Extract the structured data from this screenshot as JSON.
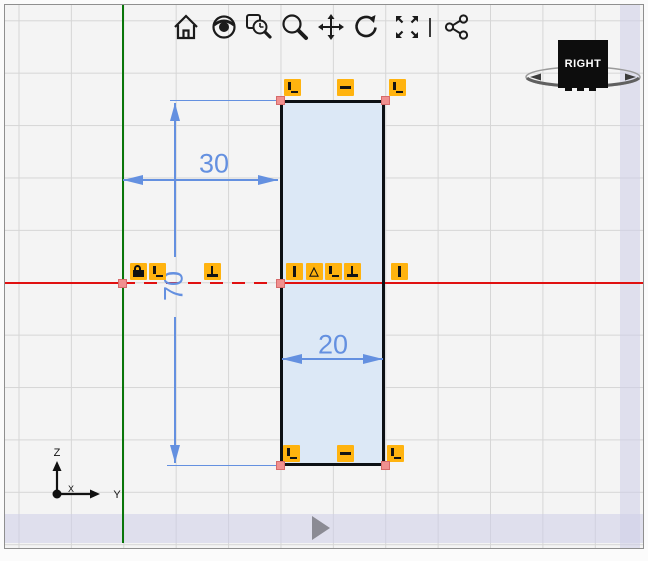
{
  "toolbar": {
    "icons": [
      {
        "name": "home"
      },
      {
        "name": "view-orientation"
      },
      {
        "name": "zoom-window"
      },
      {
        "name": "zoom"
      },
      {
        "name": "pan"
      },
      {
        "name": "rotate"
      },
      {
        "name": "zoom-to-fit"
      },
      {
        "name": "share-view"
      }
    ]
  },
  "view_cube": {
    "face_label": "RIGHT"
  },
  "triad": {
    "axis_x_label": "X",
    "axis_y_label": "Y",
    "axis_z_label": "Z"
  },
  "sketch": {
    "dimensions": [
      {
        "id": "offset-from-origin",
        "value": "30"
      },
      {
        "id": "height",
        "value": "70"
      },
      {
        "id": "width",
        "value": "20"
      }
    ],
    "badges": [
      {
        "type": "coincident",
        "x": 287,
        "y": 82
      },
      {
        "type": "horizontal",
        "x": 340,
        "y": 82
      },
      {
        "type": "coincident",
        "x": 392,
        "y": 82
      },
      {
        "type": "lock",
        "x": 133,
        "y": 266
      },
      {
        "type": "coincident",
        "x": 152,
        "y": 266
      },
      {
        "type": "perpendicular",
        "x": 207,
        "y": 266
      },
      {
        "type": "vertical",
        "x": 289,
        "y": 266
      },
      {
        "type": "triangle",
        "x": 309,
        "y": 266
      },
      {
        "type": "coincident",
        "x": 328,
        "y": 266
      },
      {
        "type": "perpendicular",
        "x": 347,
        "y": 266
      },
      {
        "type": "vertical",
        "x": 394,
        "y": 266
      },
      {
        "type": "coincident",
        "x": 286,
        "y": 448
      },
      {
        "type": "horizontal",
        "x": 340,
        "y": 448
      },
      {
        "type": "coincident",
        "x": 390,
        "y": 448
      }
    ],
    "points": [
      {
        "x": 275,
        "y": 95
      },
      {
        "x": 380,
        "y": 95
      },
      {
        "x": 117,
        "y": 278
      },
      {
        "x": 275,
        "y": 278
      },
      {
        "x": 275,
        "y": 460
      },
      {
        "x": 380,
        "y": 460
      }
    ]
  },
  "colors": {
    "dimension_blue": "#6490e0",
    "constraint_yellow": "#ffb30f",
    "vertex_pink": "#f0908f",
    "axis_red": "#e01010",
    "axis_green": "#0a760a",
    "rect_fill": "#dce8f6"
  }
}
